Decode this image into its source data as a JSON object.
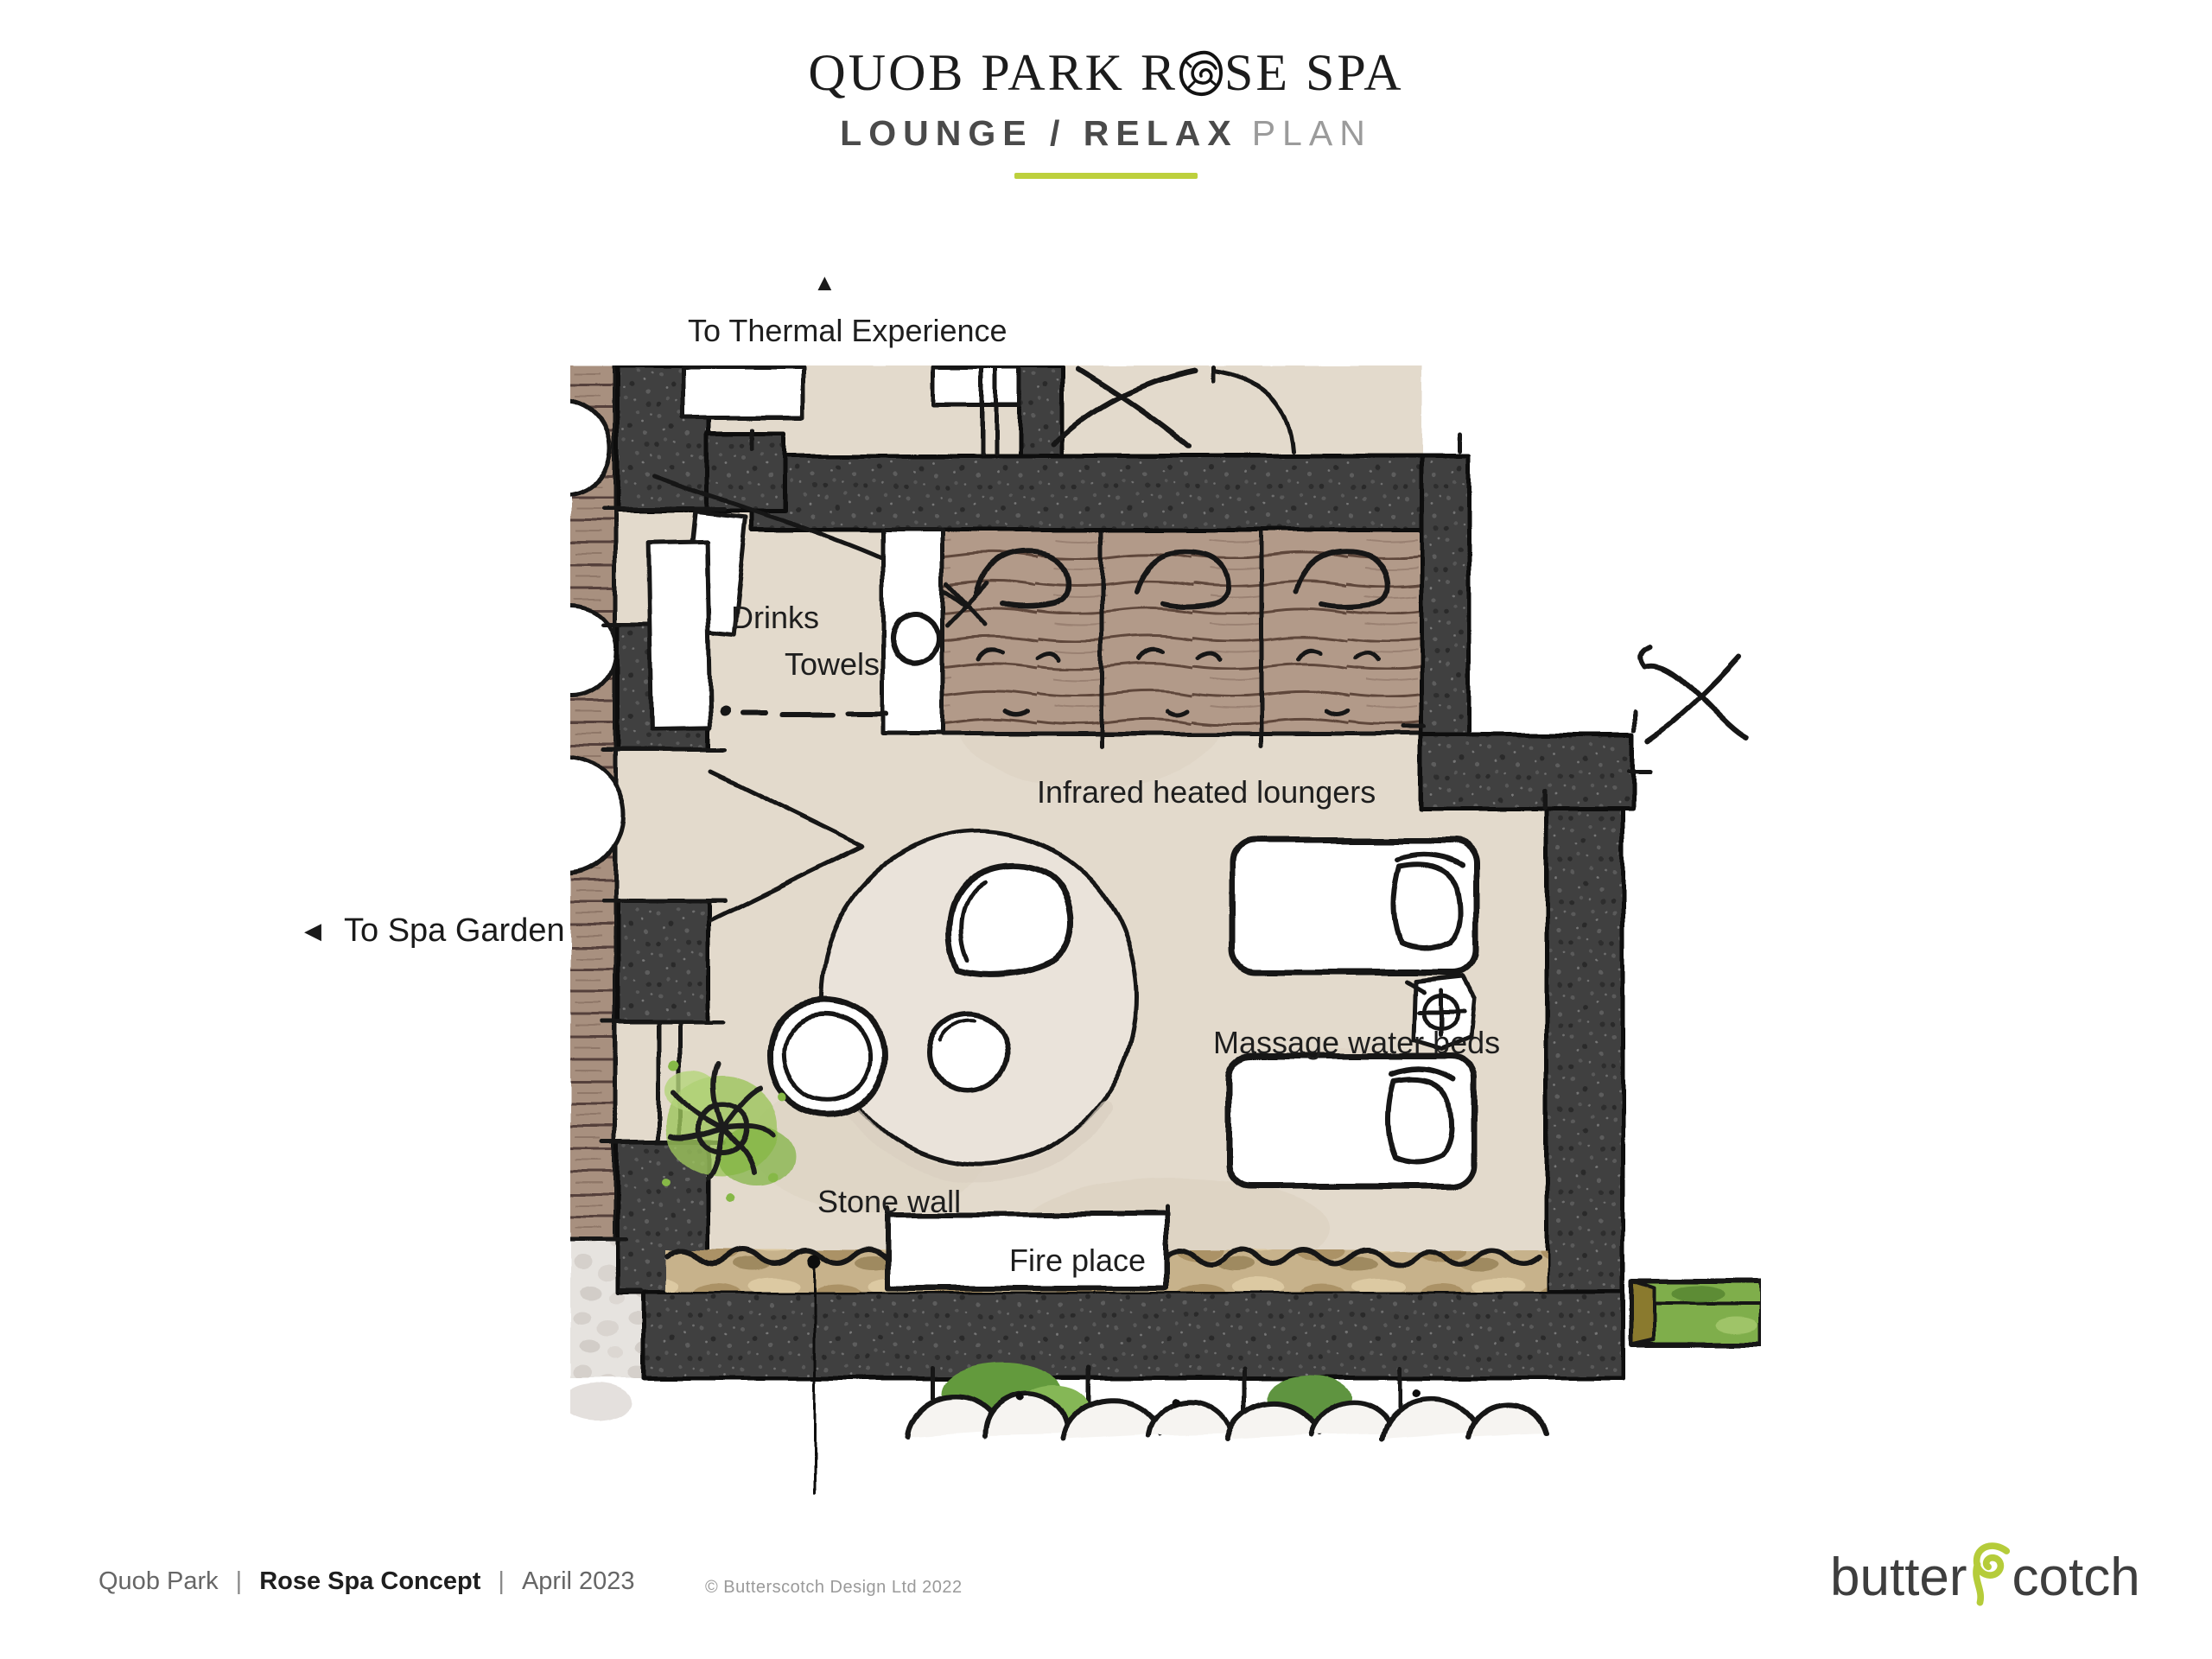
{
  "header": {
    "title_part1": "QUOB PARK R",
    "title_part2": "SE SPA",
    "rose_icon": "rose-spiral-glyph",
    "subtitle_bold": "LOUNGE / RELAX",
    "subtitle_light": "PLAN"
  },
  "plan": {
    "direction_labels": {
      "thermal": {
        "arrow": "▲",
        "text": "To Thermal Experience"
      },
      "garden": {
        "arrow": "◀",
        "text": "To Spa Garden"
      }
    },
    "room_labels": {
      "drinks": "Drinks",
      "towels": "Towels",
      "loungers": "Infrared heated loungers",
      "massage": "Massage water beds",
      "stone_wall": "Stone wall",
      "fireplace": "Fire place"
    }
  },
  "footer": {
    "left": [
      {
        "text": "Quob Park"
      },
      {
        "text": "Rose Spa Concept"
      },
      {
        "text": "April 2023"
      }
    ],
    "separator": "|",
    "copyright": "© Butterscotch Design Ltd 2022",
    "logo": {
      "part1": "butter",
      "part2": "cotch"
    }
  },
  "palette": {
    "accent_green": "#bdd03d",
    "logo_swirl_green": "#b5cc3a",
    "floor_beige": "#e3dacc",
    "wall_dark": "#404040",
    "deck_wood": "#b29a89",
    "stone_tan": "#c7b28b",
    "plant_green": "#8fbf4d"
  }
}
